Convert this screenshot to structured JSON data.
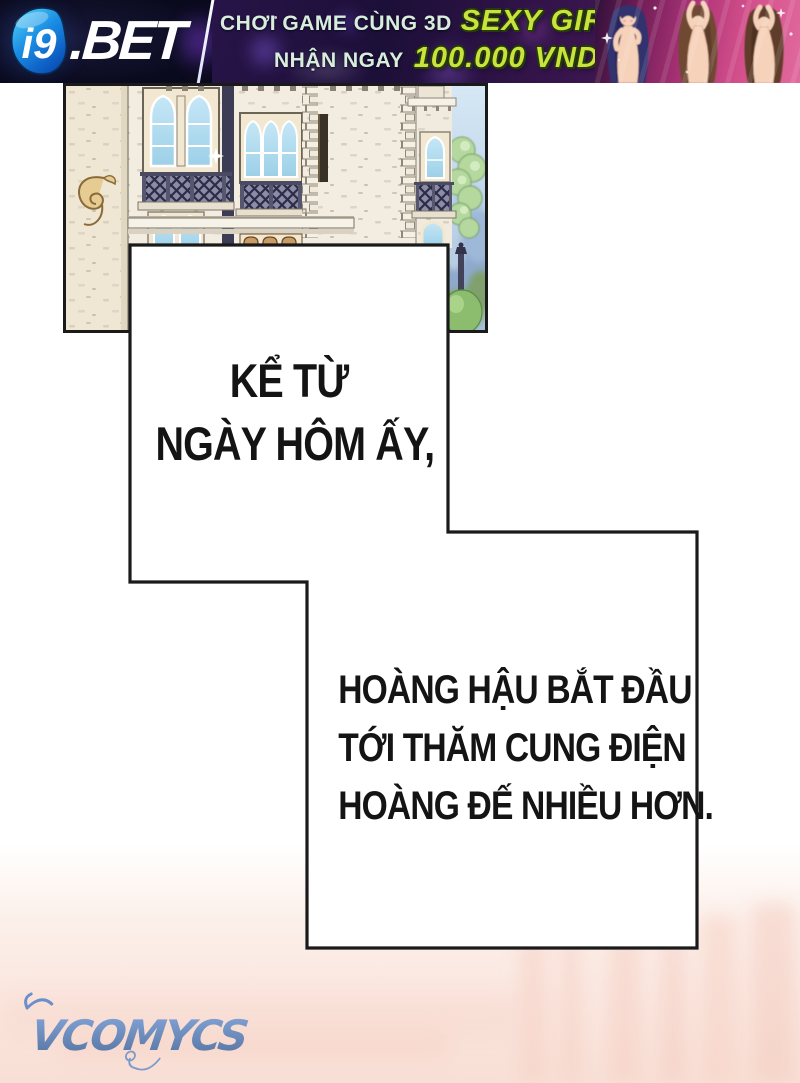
{
  "banner": {
    "brand": {
      "logo_mark": "i9",
      "logo_suffix": ".BET"
    },
    "promo": {
      "line1_text": "CHƠI GAME CÙNG 3D",
      "line1_highlight": "SEXY GIRL",
      "line2_text": "NHẬN NGAY",
      "line2_highlight": "100.000 VND"
    },
    "colors": {
      "panel_navy": "#0c0c22",
      "logo_blue": "#2bb7f0",
      "promo_mint": "#d8eedd",
      "highlight_green": "#cbe23c",
      "girls_pink": "#d4508b"
    },
    "icons": {
      "logo_mark_icon": "rounded-triangle-pick",
      "sparkle_icon": "✦"
    }
  },
  "comic": {
    "narration_box1": {
      "lines": [
        "KỂ TỪ",
        "NGÀY HÔM ẤY,"
      ]
    },
    "narration_box2": {
      "lines": [
        "HOÀNG HẬU BẮT ĐẦU",
        "TỚI THĂM CUNG ĐIỆN",
        "HOÀNG ĐẾ NHIỀU HƠN."
      ]
    },
    "colors": {
      "panel_border": "#1a1a1a",
      "box_fill": "#ffffff",
      "text": "#141414"
    }
  },
  "watermark": {
    "text": "VCOMYCS",
    "color": "#6d8fc9"
  },
  "page_colors": {
    "background_top": "#ffffff",
    "background_bottom": "#f8dfd5"
  }
}
